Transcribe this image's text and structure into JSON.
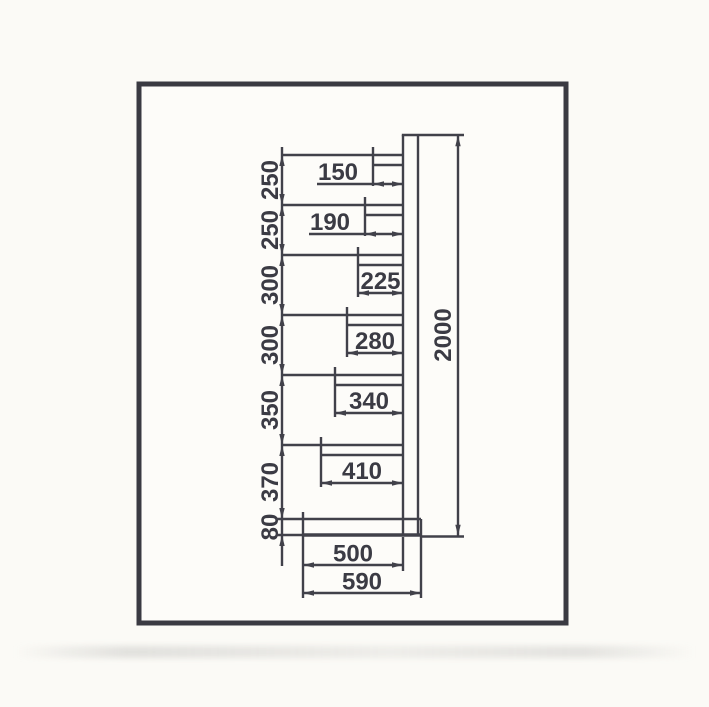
{
  "drawing": {
    "colors": {
      "ink": "#41414a",
      "frame": "#3a3a42",
      "paper": "#fdfcf9",
      "page_bg": "#fbfaf6"
    },
    "scale_units_per_px": 5,
    "line_width": 2.4,
    "frame": {
      "x": 139,
      "y": 84,
      "width": 427,
      "height": 539,
      "border": 5
    },
    "post": {
      "face_x": 403,
      "back_x": 418,
      "top_y": 135,
      "cap_end_x": 464
    },
    "overall_height_dim": {
      "label": "2000",
      "value": 2000,
      "line_x": 458,
      "text_x": 451,
      "ext_y": 536.5,
      "ext_x2": 464
    },
    "left_chain": {
      "line_x": 282,
      "label_x": 278,
      "first_level_y": 155,
      "tail_y": 566,
      "segments": [
        {
          "label": "250",
          "value": 250
        },
        {
          "label": "250",
          "value": 250
        },
        {
          "label": "300",
          "value": 300
        },
        {
          "label": "300",
          "value": 300
        },
        {
          "label": "350",
          "value": 350
        },
        {
          "label": "370",
          "value": 370
        },
        {
          "label": "80",
          "value": 80,
          "arrows": "outside"
        }
      ]
    },
    "shelves": [
      {
        "label": "150",
        "value": 150,
        "text_position": "outside"
      },
      {
        "label": "190",
        "value": 190,
        "text_position": "outside"
      },
      {
        "label": "225",
        "value": 225,
        "text_position": "inside"
      },
      {
        "label": "280",
        "value": 280,
        "text_position": "inside"
      },
      {
        "label": "340",
        "value": 340,
        "text_position": "inside"
      },
      {
        "label": "410",
        "value": 410,
        "text_position": "inside"
      }
    ],
    "base": {
      "front_x": 303,
      "rear_x": 421,
      "depth_to_post": {
        "label": "500",
        "value": 500,
        "dim_y": 565,
        "text_x": 353
      },
      "total_depth": {
        "label": "590",
        "value": 590,
        "dim_y": 593,
        "text_x": 362
      }
    }
  }
}
